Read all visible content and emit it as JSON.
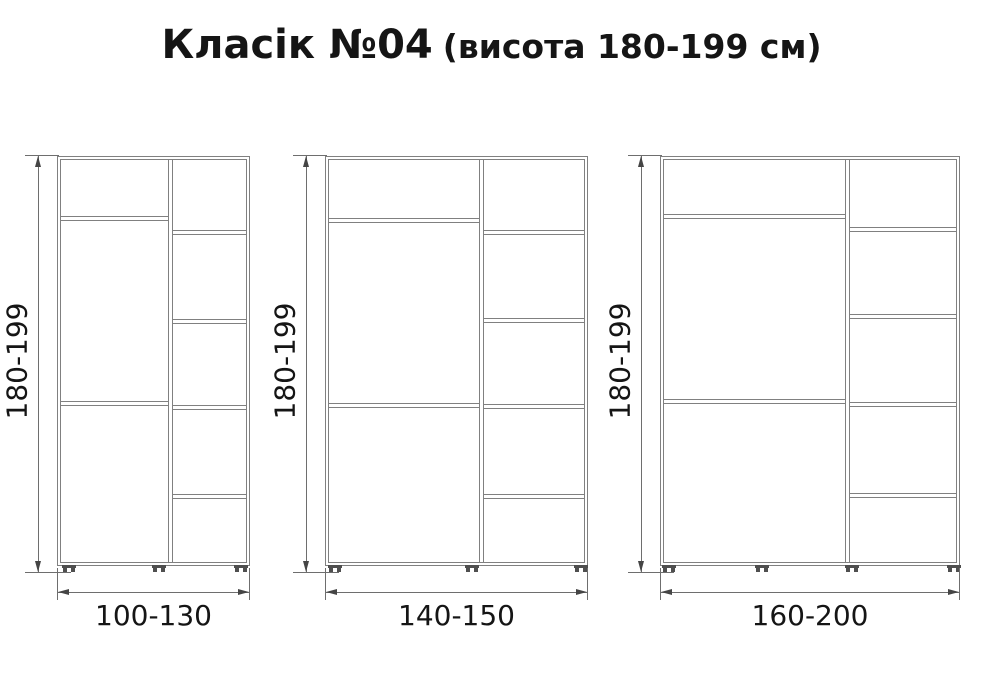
{
  "title": {
    "main": "Класік №04",
    "sub": "(висота 180-199 см)"
  },
  "colors": {
    "background": "#ffffff",
    "cabinet_line": "#808080",
    "dimension_line": "#6e6e6e",
    "arrow": "#454545",
    "feet": "#4f4f4f",
    "text": "#151515"
  },
  "diagram": {
    "body_top": 156,
    "body_height": 410,
    "width_dim_y": 592,
    "cabinets": [
      {
        "height_label": "180-199",
        "width_label": "100-130",
        "x": 57,
        "width": 193,
        "divider_x": 110,
        "left_shelves_y": [
          59,
          244
        ],
        "right_shelves_y": [
          73,
          162,
          248,
          337
        ],
        "feet_x": [
          4,
          94,
          176
        ]
      },
      {
        "height_label": "180-199",
        "width_label": "140-150",
        "x": 325,
        "width": 263,
        "divider_x": 153,
        "left_shelves_y": [
          61,
          246
        ],
        "right_shelves_y": [
          73,
          161,
          247,
          337
        ],
        "feet_x": [
          2,
          139,
          248
        ]
      },
      {
        "height_label": "180-199",
        "width_label": "160-200",
        "x": 660,
        "width": 300,
        "divider_x": 184,
        "left_shelves_y": [
          57,
          242
        ],
        "right_shelves_y": [
          70,
          157,
          245,
          336
        ],
        "feet_x": [
          1,
          94,
          184,
          286
        ]
      }
    ]
  }
}
